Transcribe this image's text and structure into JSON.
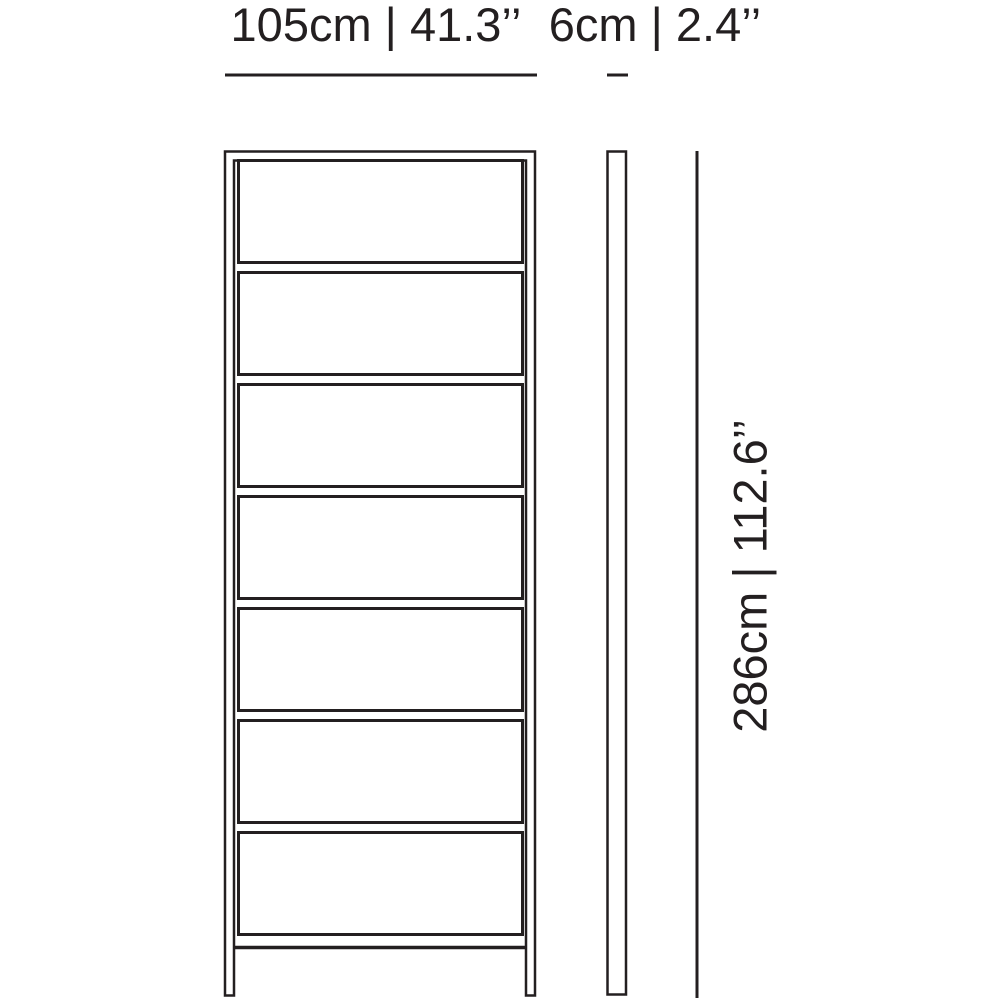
{
  "diagram": {
    "title": "shelf-dimensional-drawing",
    "ink_color": "#231f20",
    "front_view": {
      "width_label": "105cm | 41.3’’",
      "width_cm": 105,
      "width_in": 41.3,
      "shelf_count": 7
    },
    "side_view": {
      "depth_label": "6cm | 2.4’’",
      "depth_cm": 6,
      "depth_in": 2.4
    },
    "height": {
      "label": "286cm | 112.6’’",
      "height_cm": 286,
      "height_in": 112.6
    }
  }
}
